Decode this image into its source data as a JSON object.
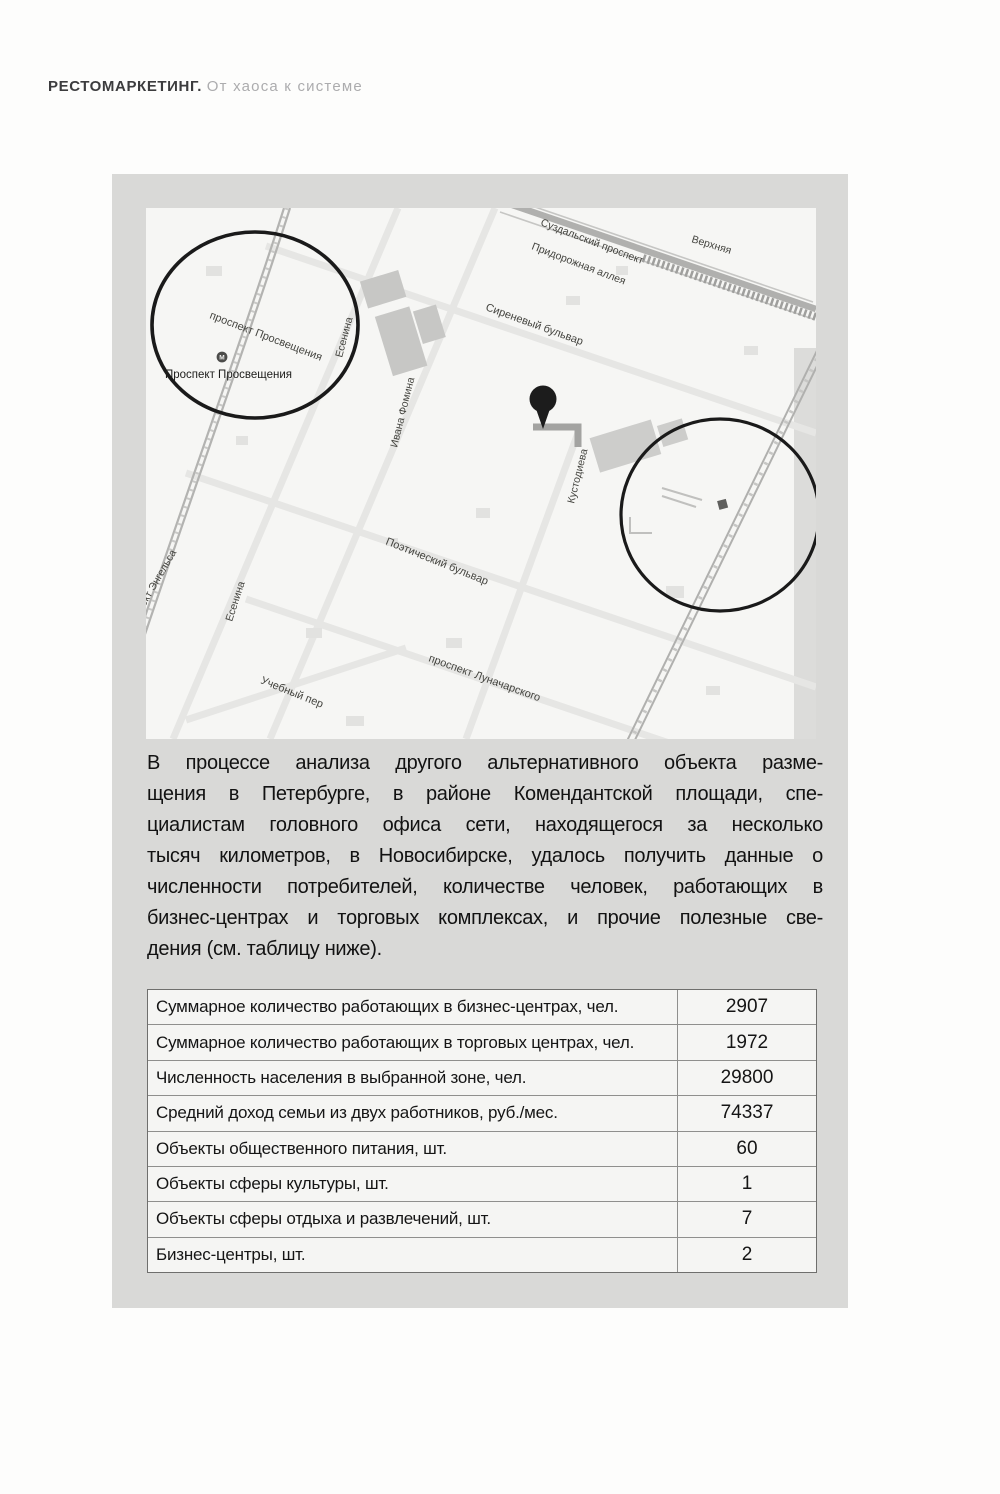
{
  "header": {
    "title_bold": "РЕСТОМАРКЕТИНГ.",
    "title_light": "От хаоса к системе"
  },
  "map": {
    "background_color": "#f6f6f4",
    "frame_color": "#d9d9d7",
    "circle_color": "#1a1a1a",
    "pin_color": "#1c1c1c",
    "metro_letter": "М",
    "labels": [
      {
        "text": "проспект Просвещения",
        "x": 63,
        "y": 110,
        "rotate": 21,
        "size": 11,
        "cls": "lbl"
      },
      {
        "text": "Проспект Просвещения",
        "x": 19,
        "y": 170,
        "rotate": 0,
        "size": 11.5,
        "cls": "lbl2"
      },
      {
        "text": "Есенина",
        "x": 196,
        "y": 150,
        "rotate": -75,
        "size": 10.5,
        "cls": "lbl"
      },
      {
        "text": "Есенина",
        "x": 86,
        "y": 414,
        "rotate": -72,
        "size": 10.5,
        "cls": "lbl"
      },
      {
        "text": "Ивана Фомина",
        "x": 251,
        "y": 240,
        "rotate": -76,
        "size": 10.5,
        "cls": "lbl"
      },
      {
        "text": "Сиреневый бульвар",
        "x": 339,
        "y": 102,
        "rotate": 20,
        "size": 11,
        "cls": "lbl"
      },
      {
        "text": "Суздальский проспект",
        "x": 394,
        "y": 17,
        "rotate": 21,
        "size": 10.5,
        "cls": "lbl"
      },
      {
        "text": "Придорожная аллея",
        "x": 385,
        "y": 41,
        "rotate": 21,
        "size": 10.5,
        "cls": "lbl"
      },
      {
        "text": "Верхняя",
        "x": 545,
        "y": 34,
        "rotate": 17,
        "size": 10.5,
        "cls": "lbl"
      },
      {
        "text": "Кустодиева",
        "x": 428,
        "y": 296,
        "rotate": -76,
        "size": 10.5,
        "cls": "lbl"
      },
      {
        "text": "Поэтический бульвар",
        "x": 239,
        "y": 336,
        "rotate": 22,
        "size": 11,
        "cls": "lbl"
      },
      {
        "text": "проспект Луначарского",
        "x": 282,
        "y": 453,
        "rotate": 20,
        "size": 11,
        "cls": "lbl"
      },
      {
        "text": "Учебный пер",
        "x": 114,
        "y": 475,
        "rotate": 22,
        "size": 11,
        "cls": "lbl"
      },
      {
        "text": "пект Энгельса",
        "x": -4,
        "y": 404,
        "rotate": -60,
        "size": 10.5,
        "cls": "lbl"
      }
    ]
  },
  "paragraph": {
    "lines": [
      "В процессе анализа другого альтернативного объекта разме-",
      "щения в Петербурге, в районе Комендантской площади, спе-",
      "циалистам головного офиса сети, находящегося за несколько",
      "тысяч километров, в Новосибирске, удалось получить данные о",
      "численности потребителей, количестве человек, работающих в",
      "бизнес-центрах и торговых комплексах, и прочие полезные све-",
      "дения (см. таблицу ниже)."
    ]
  },
  "table": {
    "rows": [
      {
        "label": "Суммарное количество работающих в бизнес-центрах, чел.",
        "value": "2907"
      },
      {
        "label": "Суммарное количество работающих в торговых центрах, чел.",
        "value": "1972"
      },
      {
        "label": "Численность населения в выбранной зоне, чел.",
        "value": "29800"
      },
      {
        "label": "Средний доход семьи из двух работников, руб./мес.",
        "value": "74337"
      },
      {
        "label": "Объекты общественного питания, шт.",
        "value": "60"
      },
      {
        "label": "Объекты сферы культуры, шт.",
        "value": "1"
      },
      {
        "label": "Объекты сферы отдыха и развлечений, шт.",
        "value": "7"
      },
      {
        "label": "Бизнес-центры, шт.",
        "value": "2"
      }
    ]
  }
}
